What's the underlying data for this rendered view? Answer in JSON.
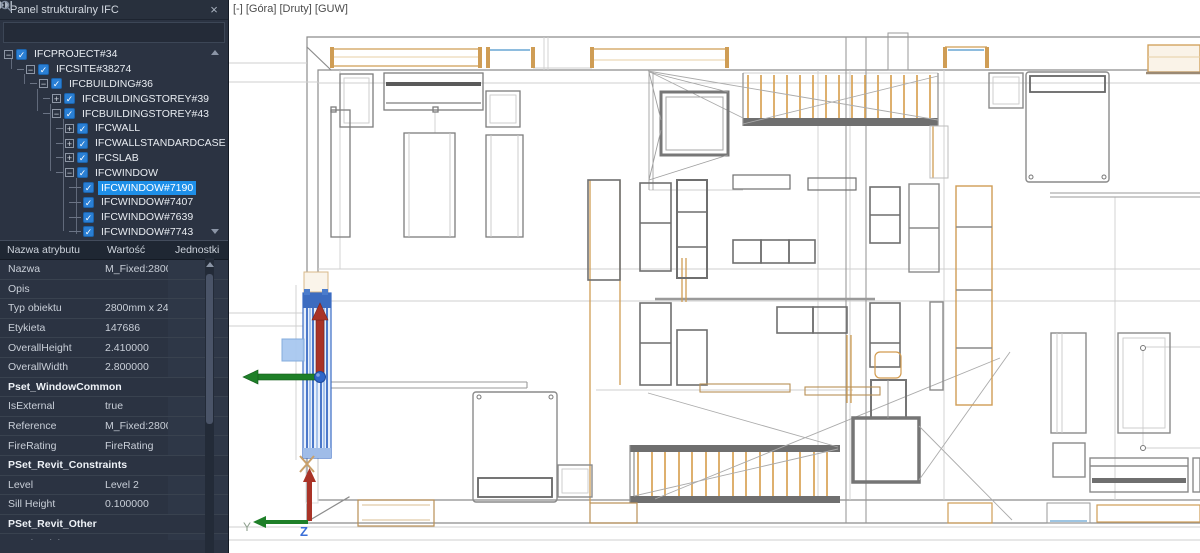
{
  "window": {
    "viewport_caption": "[-] [Góra] [Druty] [GUW]"
  },
  "panel": {
    "title": "Panel strukturalny IFC",
    "search": {
      "value": "",
      "placeholder": ""
    },
    "tree": {
      "items": [
        {
          "label": "IFCPROJECT#34",
          "level": 0,
          "expander": "minus",
          "checked": true,
          "selected": false
        },
        {
          "label": "IFCSITE#38274",
          "level": 1,
          "expander": "minus",
          "checked": true,
          "selected": false
        },
        {
          "label": "IFCBUILDING#36",
          "level": 2,
          "expander": "minus",
          "checked": true,
          "selected": false
        },
        {
          "label": "IFCBUILDINGSTOREY#39",
          "level": 3,
          "expander": "plus",
          "checked": true,
          "selected": false
        },
        {
          "label": "IFCBUILDINGSTOREY#43",
          "level": 3,
          "expander": "minus",
          "checked": true,
          "selected": false
        },
        {
          "label": "IFCWALL",
          "level": 4,
          "expander": "plus",
          "checked": true,
          "selected": false
        },
        {
          "label": "IFCWALLSTANDARDCASE",
          "level": 4,
          "expander": "plus",
          "checked": true,
          "selected": false
        },
        {
          "label": "IFCSLAB",
          "level": 4,
          "expander": "plus",
          "checked": true,
          "selected": false
        },
        {
          "label": "IFCWINDOW",
          "level": 4,
          "expander": "minus",
          "checked": true,
          "selected": false
        },
        {
          "label": "IFCWINDOW#7190",
          "level": 5,
          "expander": "none",
          "checked": true,
          "selected": true
        },
        {
          "label": "IFCWINDOW#7407",
          "level": 5,
          "expander": "none",
          "checked": true,
          "selected": false
        },
        {
          "label": "IFCWINDOW#7639",
          "level": 5,
          "expander": "none",
          "checked": true,
          "selected": false
        },
        {
          "label": "IFCWINDOW#7743",
          "level": 5,
          "expander": "none",
          "checked": true,
          "selected": false
        }
      ]
    },
    "properties": {
      "headers": [
        "Nazwa atrybutu",
        "Wartość",
        "Jednostki"
      ],
      "rows": [
        {
          "type": "row",
          "name": "Nazwa",
          "value": "M_Fixed:2800mm...",
          "unit": ""
        },
        {
          "type": "row",
          "name": "Opis",
          "value": "",
          "unit": ""
        },
        {
          "type": "row",
          "name": "Typ obiektu",
          "value": "2800mm x 2410...",
          "unit": ""
        },
        {
          "type": "row",
          "name": "Etykieta",
          "value": "147686",
          "unit": ""
        },
        {
          "type": "row",
          "name": "OverallHeight",
          "value": "2.410000",
          "unit": ""
        },
        {
          "type": "row",
          "name": "OverallWidth",
          "value": "2.800000",
          "unit": ""
        },
        {
          "type": "section",
          "name": "Pset_WindowCommon",
          "value": "",
          "unit": ""
        },
        {
          "type": "row",
          "name": "IsExternal",
          "value": "true",
          "unit": ""
        },
        {
          "type": "row",
          "name": "Reference",
          "value": "M_Fixed:2800mm...",
          "unit": ""
        },
        {
          "type": "row",
          "name": "FireRating",
          "value": "FireRating",
          "unit": ""
        },
        {
          "type": "section",
          "name": "PSet_Revit_Constraints",
          "value": "",
          "unit": ""
        },
        {
          "type": "row",
          "name": "Level",
          "value": "Level 2",
          "unit": ""
        },
        {
          "type": "row",
          "name": "Sill Height",
          "value": "0.100000",
          "unit": ""
        },
        {
          "type": "section",
          "name": "PSet_Revit_Other",
          "value": "",
          "unit": ""
        },
        {
          "type": "row",
          "name": "Head Height",
          "value": "2.510000",
          "unit": ""
        },
        {
          "type": "row",
          "name": "InstallationDate",
          "value": "InstallationDate",
          "unit": ""
        }
      ]
    }
  },
  "axes": {
    "x": "X",
    "y": "Y",
    "z": "Z"
  },
  "icons": {
    "panel_collapse": "chevrons-right",
    "panel_close": "×",
    "search": "magnifier",
    "checkbox_check": "✓",
    "expander_minus": "−",
    "expander_plus": "+"
  },
  "colors": {
    "panel_bg": "#2b3342",
    "selection_highlight": "#1e8fe8",
    "checkbox_blue": "#2a7fd4",
    "entity_selection_blue": "#3a6bc4",
    "gizmo_red": "#a93327",
    "gizmo_green": "#1e7f28",
    "gizmo_blue": "#2f66c9",
    "plan_orange": "#cf9d55",
    "plan_gray": "#8c8c8c"
  }
}
